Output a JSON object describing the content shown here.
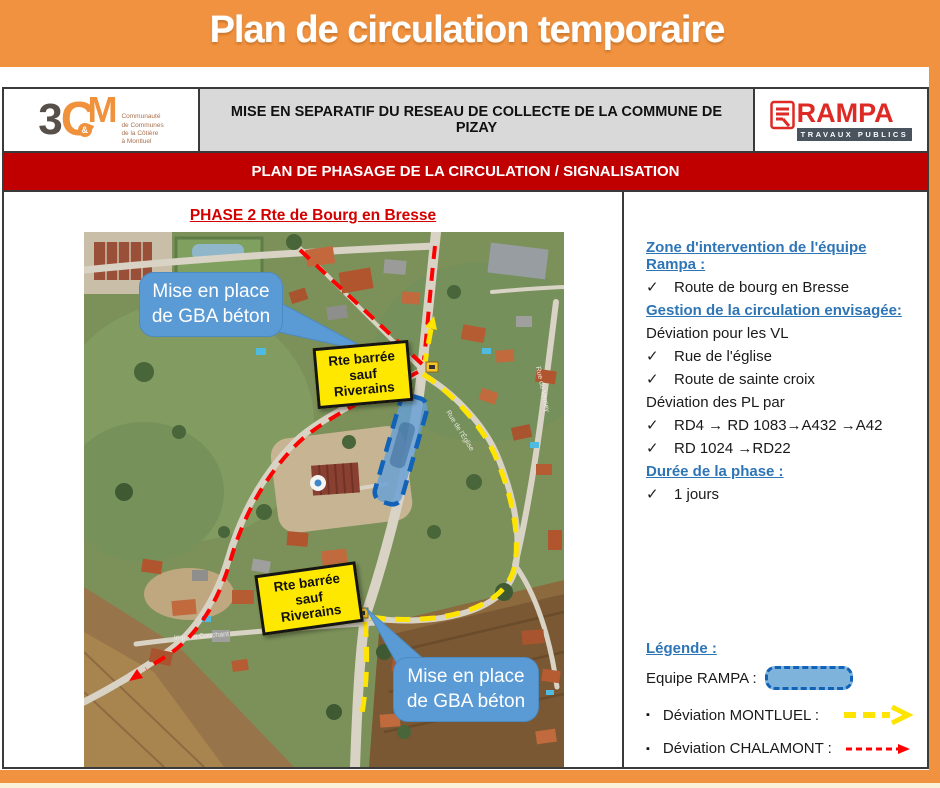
{
  "title": "Plan de circulation temporaire",
  "header": {
    "logo_3cm": {
      "digit": "3",
      "letter_c": "C",
      "amp": "&",
      "letter_m": "M",
      "subtitle_lines": [
        "Communauté",
        "de Communes",
        "de la Côtière",
        "à Montluel"
      ]
    },
    "document_title": "MISE EN SEPARATIF DU RESEAU DE COLLECTE DE LA COMMUNE DE PIZAY",
    "logo_rampa": {
      "name": "RAMPA",
      "subtitle": "TRAVAUX PUBLICS"
    }
  },
  "banner": "PLAN DE PHASAGE DE LA CIRCULATION / SIGNALISATION",
  "map": {
    "phase_title": "PHASE 2 Rte de Bourg en Bresse",
    "callout_top": "Mise en place de GBA béton",
    "callout_bottom": "Mise en place de GBA béton",
    "road_sign": {
      "line1": "Rte barrée",
      "line2": "sauf",
      "line3": "Riverains"
    },
    "street_labels": {
      "eglise": "Rue de l'Église",
      "verney": "Rue du Verney",
      "couchant": "Imp. du Couchant"
    }
  },
  "info_panel": {
    "zone_heading": "Zone d'intervention de l'équipe Rampa :",
    "zone_item": "Route de bourg en Bresse",
    "gestion_heading": "Gestion de la circulation envisagée:",
    "vl_label": "Déviation pour les VL",
    "vl_items": [
      "Rue de l'église",
      "Route de sainte croix"
    ],
    "pl_label": "Déviation des PL par",
    "pl_items": [
      "RD4 → RD 1083→A432 →A42",
      "RD 1024 →RD22"
    ],
    "duration_heading": "Durée de la phase :",
    "duration_item": "1 jours"
  },
  "legend": {
    "heading": "Légende :",
    "equipe_label": "Equipe RAMPA :",
    "montluel_label": "Déviation MONTLUEL  :",
    "chalamont_label": "Déviation CHALAMONT :"
  },
  "icons": {
    "check": "✓",
    "bullet": "▪"
  },
  "colors": {
    "frame_orange": "#F0923F",
    "banner_red": "#C00000",
    "heading_blue": "#2E75B6",
    "callout_blue": "#5B9BD5",
    "work_zone_fill": "#67A0D6",
    "work_zone_border": "#1262B8",
    "deviation_montluel_yellow": "#FFE400",
    "deviation_chalamont_red": "#FF0000",
    "road_sign_yellow": "#FFE800"
  }
}
